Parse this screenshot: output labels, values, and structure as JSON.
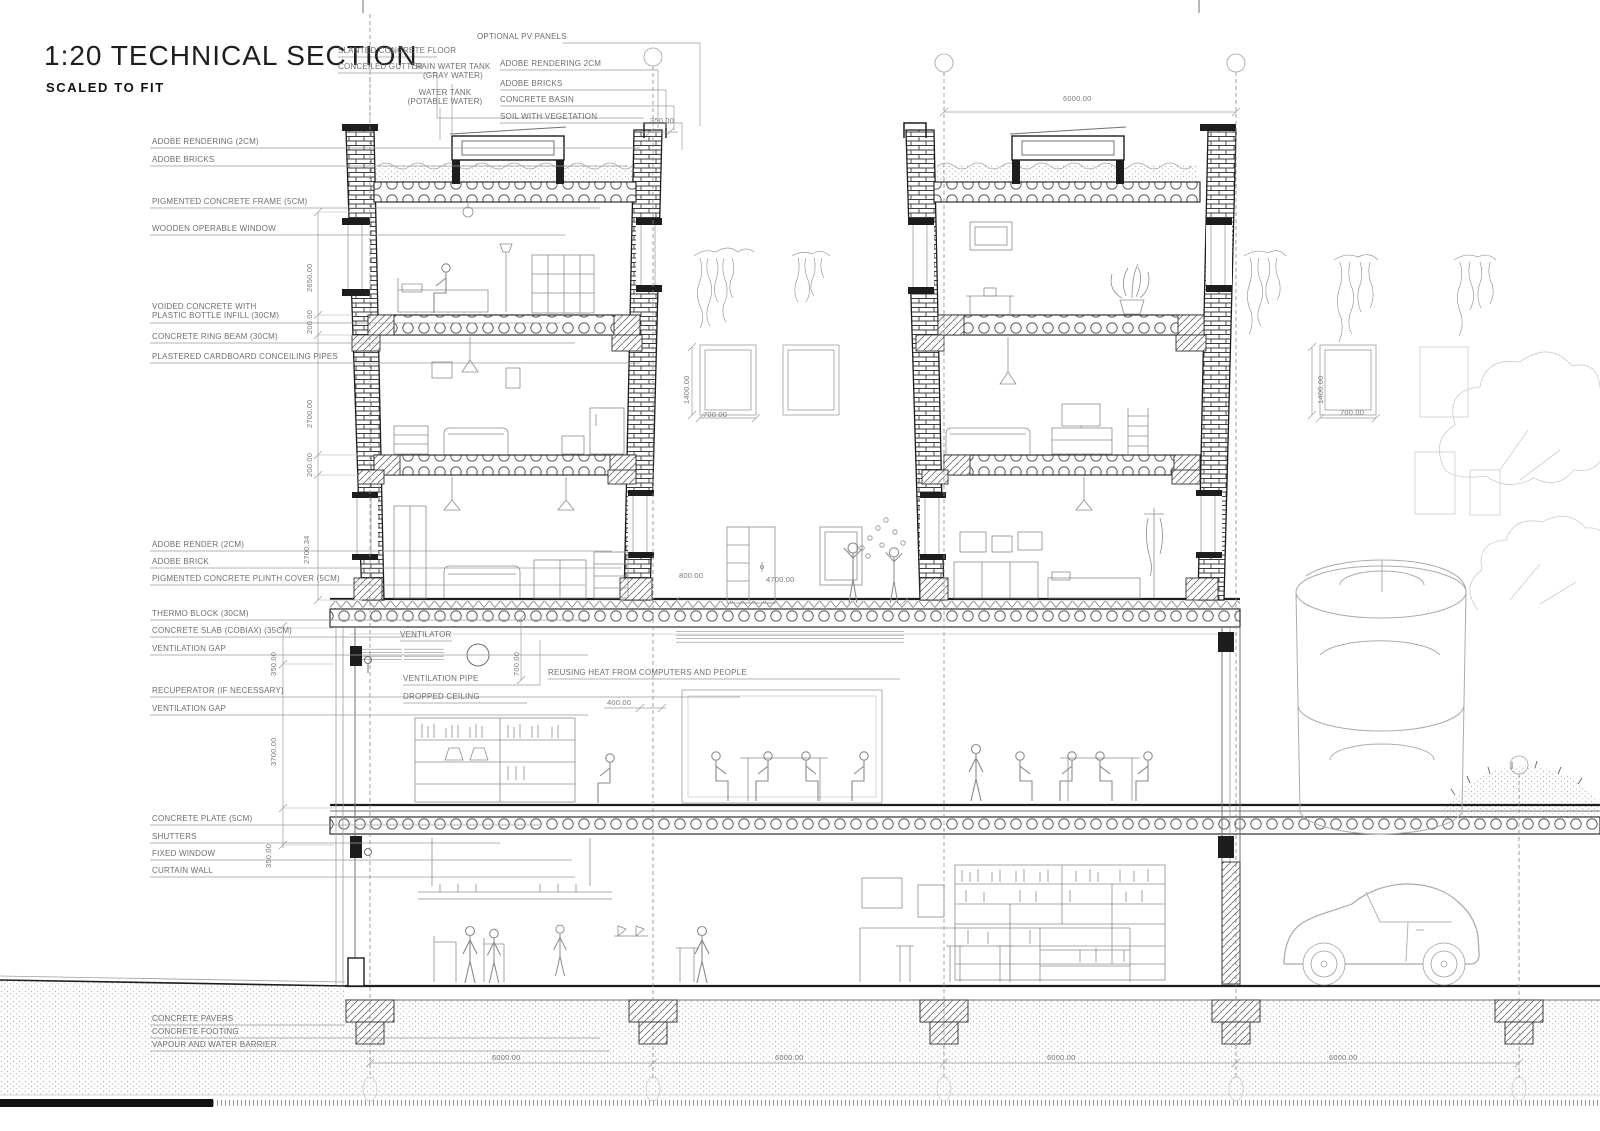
{
  "title": {
    "main": "1:20 TECHNICAL SECTION",
    "subtitle": "SCALED TO FIT"
  },
  "colors": {
    "line": "#9e9e9e",
    "cut": "#1d1d1d",
    "text": "#6f6f6f"
  },
  "top_callouts": {
    "slanted_concrete_floor": "SLANTED CONCRETE FLOOR",
    "conceiled_gutter": "CONCEILED GUTTER",
    "optional_pv_panels": "OPTIONAL PV PANELS",
    "rain_water_tank": "RAIN WATER TANK\n(GRAY WATER)",
    "water_tank": "WATER TANK\n(POTABLE WATER)",
    "adobe_rendering_2cm": "ADOBE RENDERING 2CM",
    "adobe_bricks": "ADOBE BRICKS",
    "concrete_basin": "CONCRETE BASIN",
    "soil_with_vegetation": "SOIL WITH VEGETATION"
  },
  "left_callouts": [
    "ADOBE RENDERING (2CM)",
    "ADOBE BRICKS",
    "PIGMENTED CONCRETE FRAME (5CM)",
    "WOODEN OPERABLE WINDOW",
    "VOIDED CONCRETE WITH\nPLASTIC BOTTLE INFILL (30CM)",
    "CONCRETE RING BEAM (30CM)",
    "PLASTERED CARDBOARD CONCEILING PIPES",
    "ADOBE RENDER (2CM)",
    "ADOBE BRICK",
    "PIGMENTED CONCRETE PLINTH COVER (5CM)",
    "THERMO BLOCK (30CM)",
    "CONCRETE SLAB (COBIAX) (35CM)",
    "VENTILATION GAP",
    "RECUPERATOR (IF NECESSARY)",
    "VENTILATION GAP",
    "CONCRETE PLATE (5CM)",
    "SHUTTERS",
    "FIXED WINDOW",
    "CURTAIN WALL",
    "CONCRETE PAVERS",
    "CONCRETE FOOTING",
    "VAPOUR AND WATER BARRIER"
  ],
  "interior_callouts": {
    "ventilator": "VENTILATOR",
    "ventilation_pipe": "VENTILATION PIPE",
    "dropped_ceiling": "DROPPED CEILING",
    "reusing_heat": "REUSING HEAT FROM COMPUTERS AND PEOPLE"
  },
  "dims": {
    "d350": "350.00",
    "d200": "200.00",
    "d700": "700.00",
    "d400": "400.00",
    "d800": "800.00",
    "d1400": "1400.00",
    "d2650": "2650.00",
    "d2700": "2700.00",
    "d2700_34": "2700.34",
    "d3700": "3700.00",
    "d4700": "4700.00",
    "d6000": "6000.00"
  }
}
